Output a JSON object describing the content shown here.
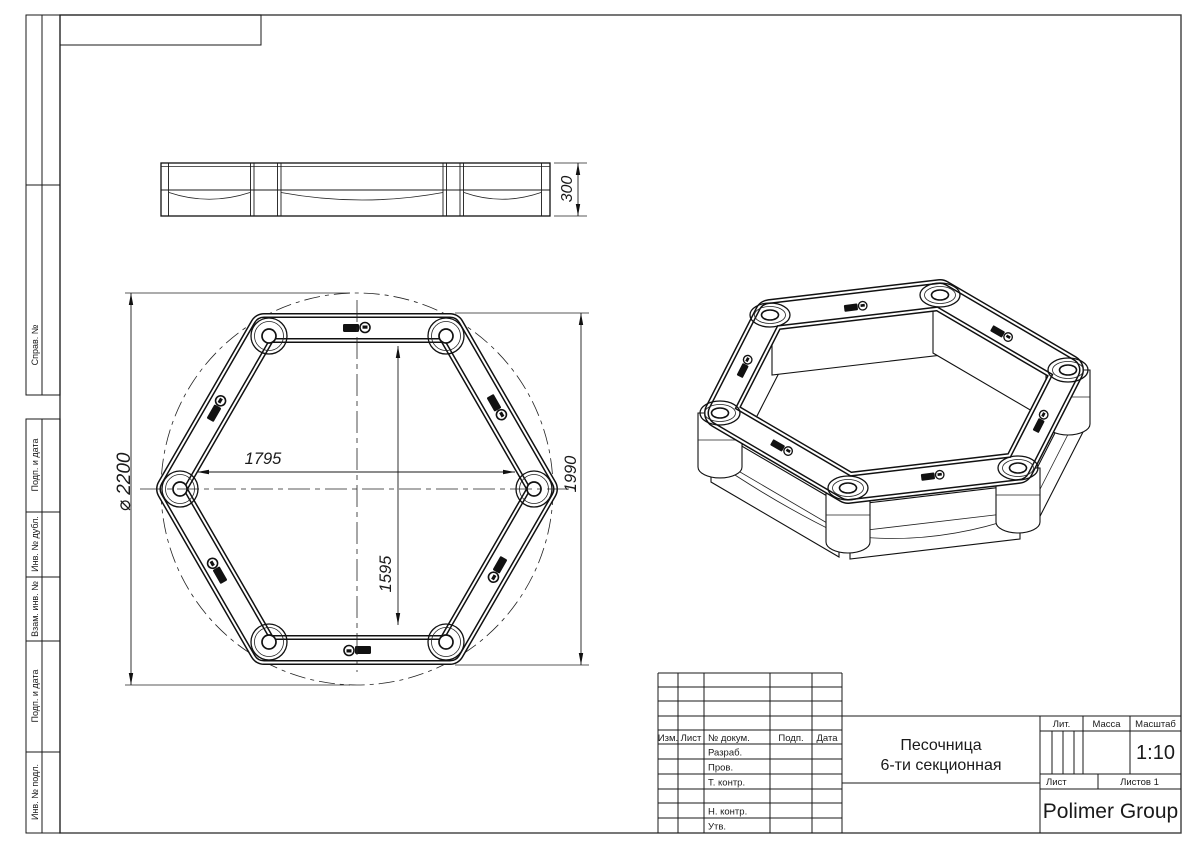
{
  "drawing": {
    "dimensions": {
      "height": "300",
      "diameter": "⌀ 2200",
      "inner_width": "1795",
      "outer_height": "1990",
      "inner_height": "1595"
    },
    "margin_labels": {
      "sprav": "Справ. №",
      "podp_data_top": "Подп. и дата",
      "inv_dubl": "Инв. № дубл.",
      "vzam_inv": "Взам. инв. №",
      "podp_data_bottom": "Подп. и дата",
      "inv_podl": "Инв. № подл."
    },
    "title_block": {
      "col_izm": "Изм.",
      "col_list": "Лист",
      "col_docnum": "№ докум.",
      "col_podp": "Подп.",
      "col_data": "Дата",
      "row_razrab": "Разраб.",
      "row_prov": "Пров.",
      "row_tkontr": "Т. контр.",
      "row_nkontr": "Н. контр.",
      "row_utv": "Утв.",
      "title_line1": "Песочница",
      "title_line2": "6-ти секционная",
      "lit": "Лит.",
      "massa": "Масса",
      "masshtab": "Масштаб",
      "scale": "1:10",
      "list": "Лист",
      "listov": "Листов 1",
      "company": "Polimer Group"
    }
  }
}
